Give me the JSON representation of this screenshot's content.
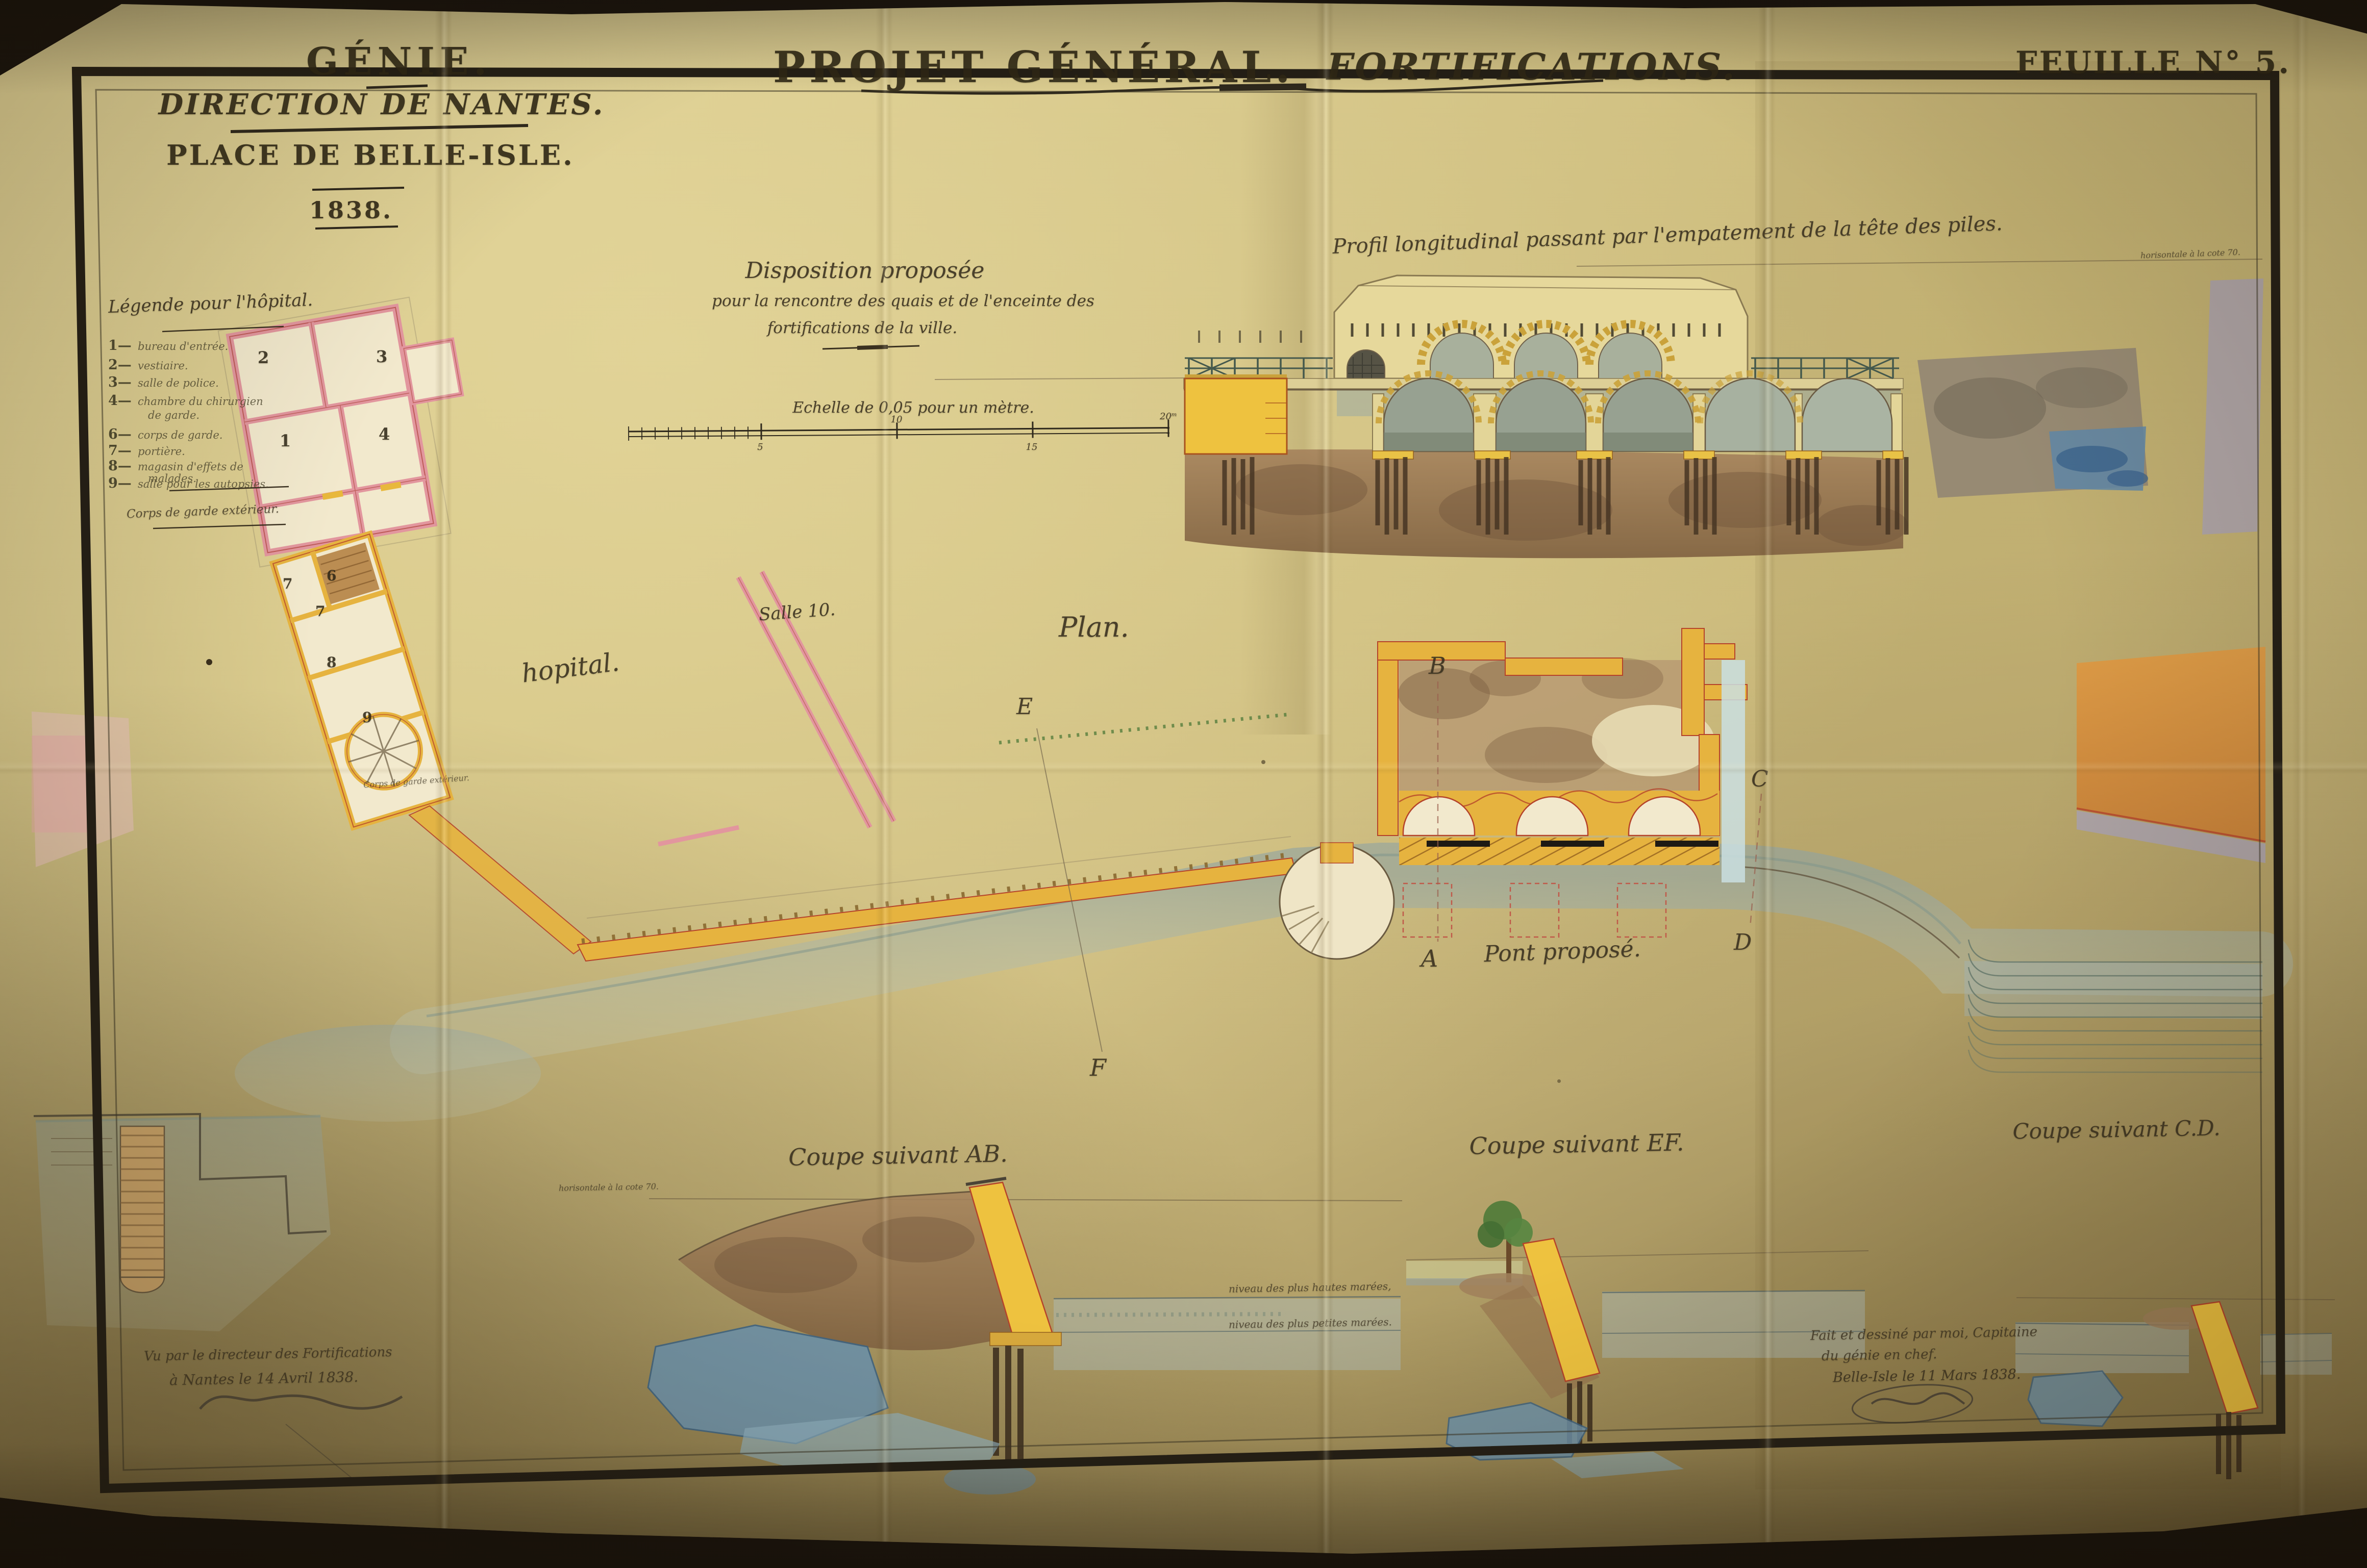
{
  "header": {
    "corner": {
      "line1": "GÉNIE.",
      "line2": "DIRECTION DE NANTES.",
      "line3": "PLACE DE BELLE-ISLE.",
      "year": "1838."
    },
    "title": {
      "part1": "PROJET GÉNÉRAL.",
      "part2": "FORTIFICATIONS."
    },
    "sheet": "FEUILLE N° 5."
  },
  "captions": {
    "disposition_l1": "Disposition proposée",
    "disposition_l2": "pour la rencontre des quais et de l'enceinte des",
    "disposition_l3": "fortifications de la ville.",
    "profil": "Profil longitudinal passant par l'empatement de la tête des piles.",
    "profil_note": "horisontale à la cote 70.",
    "echelle": "Echelle de 0,05 pour un mètre.",
    "plan": "Plan.",
    "hopital": "hopital.",
    "salle": "Salle 10.",
    "pont": "Pont proposé.",
    "coupe_ab": "Coupe suivant AB.",
    "coupe_ef": "Coupe suivant EF.",
    "coupe_cd": "Coupe suivant C.D.",
    "coupe_ab_note": "horisontale à la cote 70.",
    "niveau_haut": "niveau des plus hautes marées,",
    "niveau_bas": "niveau des plus petites marées.",
    "corps_garde_plan": "Corps de garde extérieur."
  },
  "legend": {
    "title": "Légende pour l'hôpital.",
    "items": [
      {
        "num": "1—",
        "label": "bureau d'entrée."
      },
      {
        "num": "2—",
        "label": "vestiaire."
      },
      {
        "num": "3—",
        "label": "salle de police."
      },
      {
        "num": "4—",
        "label": "chambre du chirurgien"
      },
      {
        "num": "",
        "label": "de garde."
      },
      {
        "num": "6—",
        "label": "corps de garde."
      },
      {
        "num": "7—",
        "label": "portière."
      },
      {
        "num": "8—",
        "label": "magasin d'effets de"
      },
      {
        "num": "",
        "label": "malades."
      },
      {
        "num": "9—",
        "label": "salle pour les autopsies."
      }
    ],
    "footer": "Corps de garde extérieur."
  },
  "markers": {
    "a": "A",
    "b": "B",
    "c": "C",
    "d": "D",
    "e": "E",
    "f": "F"
  },
  "rooms": {
    "r1": "1",
    "r2": "2",
    "r3": "3",
    "r4": "4",
    "r6": "6",
    "r7a": "7",
    "r7b": "7",
    "r8": "8",
    "r9": "9"
  },
  "scale": {
    "ticks": [
      "5",
      "10",
      "15"
    ],
    "end": "20ᵐ"
  },
  "signatures": {
    "left_l1": "Vu par le directeur des Fortifications",
    "left_l2": "à Nantes le 14 Avril 1838.",
    "right_l1": "Fait et dessiné par moi, Capitaine",
    "right_l2": "du génie en chef.",
    "right_l3": "Belle-Isle le 11 Mars 1838."
  },
  "colors": {
    "paper": "#d3c384",
    "frame": "#241f16",
    "hospital_pink": "#e2969e",
    "wall_yellow": "#e6b33f",
    "outline_red": "#b5432a",
    "earth": "#96744e",
    "water": "#a9b8b4",
    "rock_blue": "#6e93ab",
    "pile": "#463523",
    "railing": "#44584c",
    "glacis_orange": "#dd9440",
    "band_lavender": "#a9a1b3",
    "tree_green": "#4e7a39"
  }
}
